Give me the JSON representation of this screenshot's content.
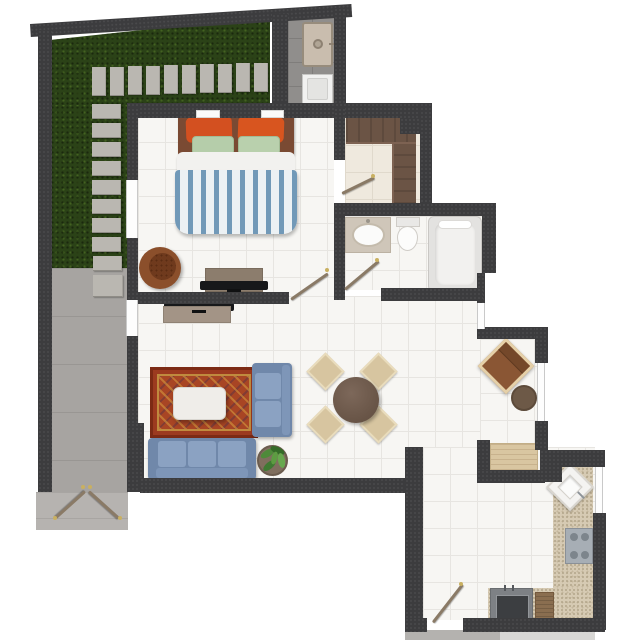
{
  "scene": {
    "type": "apartment-floor-plan-render",
    "view": "top-down",
    "units_text_visible": false
  },
  "palette": {
    "wall": "#3c3c3e",
    "floor_tile": "#f7f6f3",
    "closet_floor": "#efe9de",
    "grass": "#2b4217",
    "paver": "#bab7b1",
    "concrete_path": "#a7a4a1",
    "porch": "#b6b3b0",
    "sofa_blue": "#7e96b8",
    "rug_red": "#9c3a1f",
    "rug_gold": "#d8a040",
    "wood_dark": "#6b5445",
    "wood_console": "#8c7d6d",
    "counter_speckle": "#d6cab3",
    "pillow_orange": "#d35020",
    "pillow_green": "#b5cdaa",
    "duvet_stripe": "#7199b8",
    "chair_beige": "#d7c5a0",
    "armchair_brown": "#8a5634",
    "appliance_gray": "#7e8185"
  },
  "rooms": {
    "garden": {
      "label": "Garden terrace with stepping stones and entry walkway",
      "items": [
        "grass",
        "stepping-stones",
        "concrete-walkway",
        "entry-double-door",
        "porch"
      ]
    },
    "laundry": {
      "label": "Laundry nook",
      "items": [
        "utility-sink",
        "washing-machine"
      ]
    },
    "bedroom": {
      "label": "Bedroom",
      "items": [
        "double-bed",
        "orange-pillows",
        "green-pillows",
        "striped-duvet",
        "wall-shelves",
        "round-lounge-chair",
        "tv-console",
        "tv",
        "door"
      ]
    },
    "closet": {
      "label": "Walk-in closet",
      "items": [
        "l-shaped-wardrobe",
        "door"
      ]
    },
    "bathroom": {
      "label": "Bathroom",
      "items": [
        "vanity-sink",
        "toilet",
        "bathtub",
        "door"
      ]
    },
    "living": {
      "label": "Living room",
      "items": [
        "three-seat-sofa",
        "chaise-sofa",
        "oriental-rug",
        "coffee-table",
        "potted-plant",
        "tv-console",
        "tv",
        "window"
      ]
    },
    "dining": {
      "label": "Dining area",
      "items": [
        "round-table",
        "four-chairs"
      ]
    },
    "nook": {
      "label": "Reading nook",
      "items": [
        "armchair",
        "side-table",
        "window"
      ]
    },
    "office": {
      "label": "Built-in desk niche",
      "items": [
        "wood-counter"
      ]
    },
    "kitchen": {
      "label": "Kitchen",
      "items": [
        "corner-sink",
        "cooktop",
        "speckled-counter",
        "oven-unit",
        "cutting-board",
        "door",
        "window"
      ]
    }
  }
}
